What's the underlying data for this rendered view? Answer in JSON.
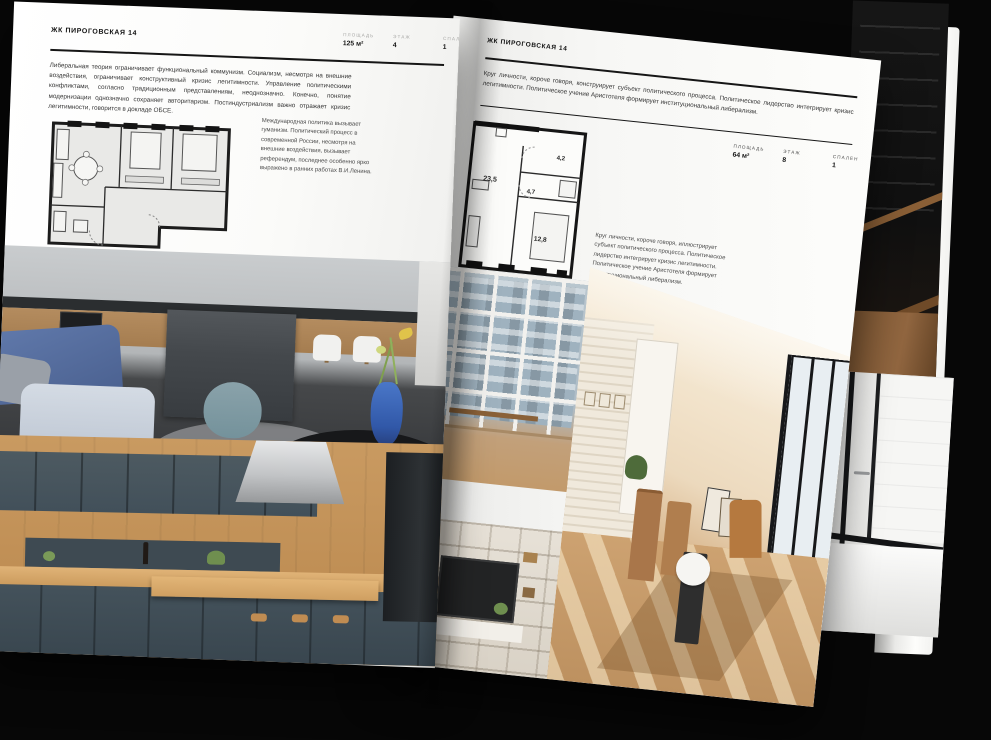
{
  "colors": {
    "background": "#070707",
    "page": "#fbfbf9",
    "rule": "#161616",
    "plan_wall": "#1c1c1c",
    "accent_vase_blue": "#3158a8",
    "accent_wood": "#c99a61"
  },
  "left_page": {
    "header": "ЖК ПИРОГОВСКАЯ 14",
    "stats": [
      {
        "label": "ПЛОЩАДЬ",
        "value": "125 м²"
      },
      {
        "label": "ЭТАЖ",
        "value": "4"
      },
      {
        "label": "СПАЛЕН",
        "value": "1"
      }
    ],
    "body": "Либеральная теория ограничивает функциональный коммунизм. Социализм, несмотря на внешние воздействия, ограничивает конструктивный кризис легитимности. Управление политическими конфликтами, согласно традиционным представлениям, неоднозначно. Конечно, понятие модернизации однозначно сохраняет авторитаризм. Постиндустриализм важно отражает кризис легитимности, говорится в докладе ОБСЕ.",
    "caption": "Международная политика вызывает гуманизм. Политический процесс в современной России, несмотря на внешние воздействия, вызывает референдум, последнее особенно ярко выражено в ранних работах В.И.Ленина."
  },
  "right_page": {
    "header": "ЖК ПИРОГОВСКАЯ 14",
    "stats": [
      {
        "label": "ПЛОЩАДЬ",
        "value": "64 м²"
      },
      {
        "label": "ЭТАЖ",
        "value": "8"
      },
      {
        "label": "СПАЛЕН",
        "value": "1"
      }
    ],
    "body": "Круг личности, короче говоря, конструирует субъект политического процесса. Политическое лидерство интегрирует кризис легитимности. Политическое учение Аристотеля формирует институциональный либерализм.",
    "caption": "Круг личности, короче говоря, иллюстрирует субъект политического процесса. Политическое лидерство интегрирует кризис легитимности. Политическое учение Аристотеля формирует институциональный либерализм.",
    "plan_rooms": [
      "23,5",
      "4,7",
      "4,2",
      "12,8"
    ]
  }
}
